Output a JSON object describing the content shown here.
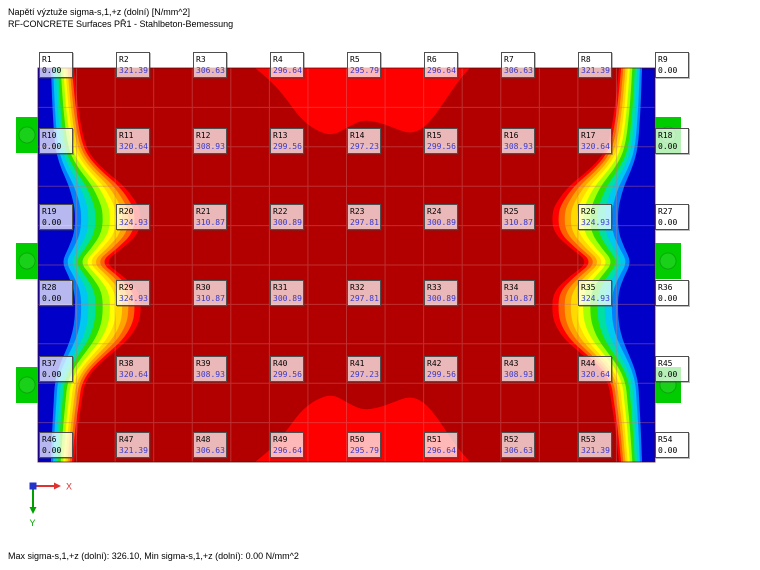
{
  "app": {
    "title_line1": "Napětí výztuže sigma-s,1,+z (dolní) [N/mm^2]",
    "title_line2": "RF-CONCRETE Surfaces PŘ1 - Stahlbeton-Bemessung",
    "status_text": "Max sigma-s,1,+z (dolní): 326.10, Min sigma-s,1,+z (dolní): 0.00 N/mm^2"
  },
  "axes": {
    "x_label": "X",
    "y_label": "Y",
    "x_color": "#e03030",
    "y_color": "#00a000",
    "origin_color": "#2233cc"
  },
  "chart_data": {
    "type": "heatmap",
    "title": "Napětí výztuže sigma-s,1,+z (dolní) [N/mm^2]",
    "unit": "N/mm^2",
    "min": 0.0,
    "max": 326.1,
    "node_grid": {
      "cols": 9,
      "rows": 6
    },
    "nodes": [
      {
        "id": "R1",
        "value": "0.00"
      },
      {
        "id": "R2",
        "value": "321.39"
      },
      {
        "id": "R3",
        "value": "306.63"
      },
      {
        "id": "R4",
        "value": "296.64"
      },
      {
        "id": "R5",
        "value": "295.79"
      },
      {
        "id": "R6",
        "value": "296.64"
      },
      {
        "id": "R7",
        "value": "306.63"
      },
      {
        "id": "R8",
        "value": "321.39"
      },
      {
        "id": "R9",
        "value": "0.00"
      },
      {
        "id": "R10",
        "value": "0.00"
      },
      {
        "id": "R11",
        "value": "320.64"
      },
      {
        "id": "R12",
        "value": "308.93"
      },
      {
        "id": "R13",
        "value": "299.56"
      },
      {
        "id": "R14",
        "value": "297.23"
      },
      {
        "id": "R15",
        "value": "299.56"
      },
      {
        "id": "R16",
        "value": "308.93"
      },
      {
        "id": "R17",
        "value": "320.64"
      },
      {
        "id": "R18",
        "value": "0.00"
      },
      {
        "id": "R19",
        "value": "0.00"
      },
      {
        "id": "R20",
        "value": "324.93"
      },
      {
        "id": "R21",
        "value": "310.87"
      },
      {
        "id": "R22",
        "value": "300.89"
      },
      {
        "id": "R23",
        "value": "297.81"
      },
      {
        "id": "R24",
        "value": "300.89"
      },
      {
        "id": "R25",
        "value": "310.87"
      },
      {
        "id": "R26",
        "value": "324.93"
      },
      {
        "id": "R27",
        "value": "0.00"
      },
      {
        "id": "R28",
        "value": "0.00"
      },
      {
        "id": "R29",
        "value": "324.93"
      },
      {
        "id": "R30",
        "value": "310.87"
      },
      {
        "id": "R31",
        "value": "300.89"
      },
      {
        "id": "R32",
        "value": "297.81"
      },
      {
        "id": "R33",
        "value": "300.89"
      },
      {
        "id": "R34",
        "value": "310.87"
      },
      {
        "id": "R35",
        "value": "324.93"
      },
      {
        "id": "R36",
        "value": "0.00"
      },
      {
        "id": "R37",
        "value": "0.00"
      },
      {
        "id": "R38",
        "value": "320.64"
      },
      {
        "id": "R39",
        "value": "308.93"
      },
      {
        "id": "R40",
        "value": "299.56"
      },
      {
        "id": "R41",
        "value": "297.23"
      },
      {
        "id": "R42",
        "value": "299.56"
      },
      {
        "id": "R43",
        "value": "308.93"
      },
      {
        "id": "R44",
        "value": "320.64"
      },
      {
        "id": "R45",
        "value": "0.00"
      },
      {
        "id": "R46",
        "value": "0.00"
      },
      {
        "id": "R47",
        "value": "321.39"
      },
      {
        "id": "R48",
        "value": "306.63"
      },
      {
        "id": "R49",
        "value": "296.64"
      },
      {
        "id": "R50",
        "value": "295.79"
      },
      {
        "id": "R51",
        "value": "296.64"
      },
      {
        "id": "R52",
        "value": "306.63"
      },
      {
        "id": "R53",
        "value": "321.39"
      },
      {
        "id": "R54",
        "value": "0.00"
      }
    ]
  },
  "labels_layout": {
    "x0": 39,
    "y0": 52,
    "dx": 77,
    "dy": 76
  },
  "canvas": {
    "plot": {
      "left": 38,
      "top": 68,
      "right": 655,
      "bottom": 462
    },
    "slab_color": "#b20000",
    "hot_color": "#ff0000",
    "support_color": "#00cc00",
    "grid_color": "rgba(205,115,115,0.42)",
    "border_color": "rgba(80,10,10,0.75)",
    "mesh": {
      "cols": 16,
      "rows": 10
    },
    "edge_profile": [
      [
        68,
        36
      ],
      [
        100,
        39
      ],
      [
        125,
        43
      ],
      [
        140,
        46
      ],
      [
        155,
        52
      ],
      [
        170,
        66
      ],
      [
        185,
        85
      ],
      [
        200,
        97
      ],
      [
        212,
        103
      ],
      [
        232,
        102
      ],
      [
        248,
        85
      ],
      [
        262,
        66
      ],
      [
        276,
        85
      ],
      [
        292,
        102
      ],
      [
        312,
        103
      ],
      [
        325,
        100
      ],
      [
        340,
        90
      ],
      [
        355,
        72
      ],
      [
        370,
        55
      ],
      [
        385,
        46
      ],
      [
        400,
        44
      ],
      [
        425,
        40
      ],
      [
        462,
        36
      ]
    ],
    "bands": [
      {
        "f": 1.0,
        "color": "#ff0000"
      },
      {
        "f": 0.94,
        "color": "#ff6000"
      },
      {
        "f": 0.88,
        "color": "#ffa300"
      },
      {
        "f": 0.82,
        "color": "#ffd900"
      },
      {
        "f": 0.76,
        "color": "#ffff00"
      },
      {
        "f": 0.7,
        "color": "#a8ff00"
      },
      {
        "f": 0.63,
        "color": "#2ce000"
      },
      {
        "f": 0.56,
        "color": "#00e0a0"
      },
      {
        "f": 0.49,
        "color": "#00c8f0"
      },
      {
        "f": 0.42,
        "color": "#0080ff"
      },
      {
        "f": 0.36,
        "color": "#0000c8"
      }
    ],
    "top_blob": [
      [
        255,
        68
      ],
      [
        270,
        80
      ],
      [
        285,
        97
      ],
      [
        300,
        118
      ],
      [
        315,
        130
      ],
      [
        332,
        136
      ],
      [
        348,
        127
      ],
      [
        362,
        120
      ],
      [
        378,
        122
      ],
      [
        394,
        128
      ],
      [
        410,
        134
      ],
      [
        424,
        128
      ],
      [
        436,
        114
      ],
      [
        448,
        96
      ],
      [
        460,
        79
      ],
      [
        470,
        68
      ]
    ],
    "supports": {
      "ys": [
        117,
        243,
        367
      ],
      "h": 36,
      "left_x": 16,
      "left_w": 22,
      "right_x": 655,
      "right_w": 26
    }
  }
}
